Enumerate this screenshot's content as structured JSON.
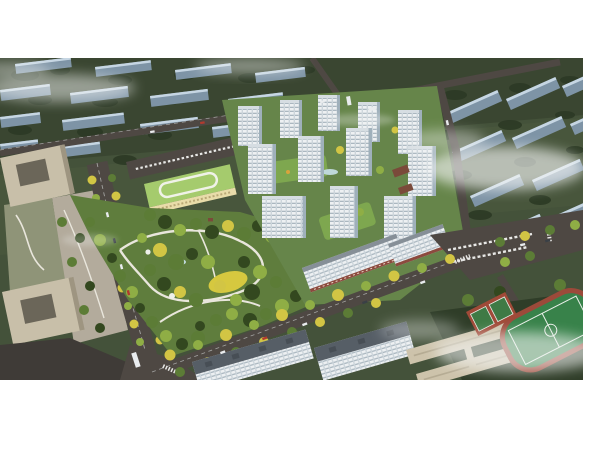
{
  "image": {
    "type": "aerial-architectural-rendering",
    "subject": "bird's-eye masterplan rendering of a residential development with white high-rise towers around a large landscaped central park",
    "text_content": "none"
  },
  "palette": {
    "page_bg": "#ffffff",
    "terrain": "#44523a",
    "terrain_dark": "#36422d",
    "terrain_light": "#4d5c40",
    "tree_dark": "#2c3a25",
    "tree_mid": "#5c7c36",
    "tree_light": "#8fae45",
    "tree_gold": "#d2c544",
    "slab_face": "#7e94a6",
    "slab_top": "#c6d6e3",
    "road": "#4e4843",
    "road_dark": "#3f3b37",
    "tower_white": "#edf0f2",
    "tower_floor": "#aab7c0",
    "tower_shadow": "#9fb0bb",
    "roof_light": "#d6dde2",
    "roof_dark": "#565e66",
    "awning_red": "#8c4a3e",
    "office_beige": "#c8bfa9",
    "office_court": "#6b6659",
    "plaza": "#b3ab9c",
    "park_green": "#5f7d3d",
    "lawn_yellow": "#d6c83f",
    "path_white": "#e9e6dc",
    "kindergarten_roof": "#a5cb6d",
    "kindergarten_wall": "#e8dca9",
    "school_wall": "#cdc3ab",
    "school_roof": "#b5ab93",
    "pitch_green": "#38824a",
    "court_red": "#a04a38",
    "pool_blue": "#bfd8da",
    "cloud": "#f4f6f5"
  },
  "scene_regions": [
    {
      "name": "surrounding-district",
      "desc": "rows of grey-blue existing apartment slabs on dark green terrain, partly under fog"
    },
    {
      "name": "residential-towers",
      "count": 12,
      "desc": "white mid-rise towers with horizontal floor bands around a green podium courtyard"
    },
    {
      "name": "street-wall-slabs",
      "count": 2,
      "desc": "long white slabs with red shop awnings along the south street"
    },
    {
      "name": "central-park",
      "desc": "dense mixed trees, looping white paths, yellow lawn, small pavilions"
    },
    {
      "name": "kindergarten",
      "desc": "three-storey cream building with light-green roof and white loop track"
    },
    {
      "name": "tree-lined-avenue",
      "desc": "wide avenue on the west side with yellow street trees"
    },
    {
      "name": "south-boulevard",
      "desc": "diagonal boulevard with gold/green street trees"
    },
    {
      "name": "office-complex",
      "desc": "beige courtyard office blocks on the west edge with plaza"
    },
    {
      "name": "foreground-slabs",
      "count": 2,
      "desc": "white slabs with dark grey roofs at the bottom edge"
    },
    {
      "name": "school-campus",
      "desc": "tan teaching wings, parking, basketball courts and green sports pitch"
    },
    {
      "name": "fog-clouds",
      "desc": "white haze wisps over the background blocks and lower right corner"
    },
    {
      "name": "vehicles",
      "desc": "small white, red and dark cars and buses on roads and parking rows"
    }
  ],
  "canvas": {
    "width": 600,
    "height": 450,
    "image_area": {
      "x": 0,
      "y": 58,
      "w": 583,
      "h": 322
    }
  }
}
